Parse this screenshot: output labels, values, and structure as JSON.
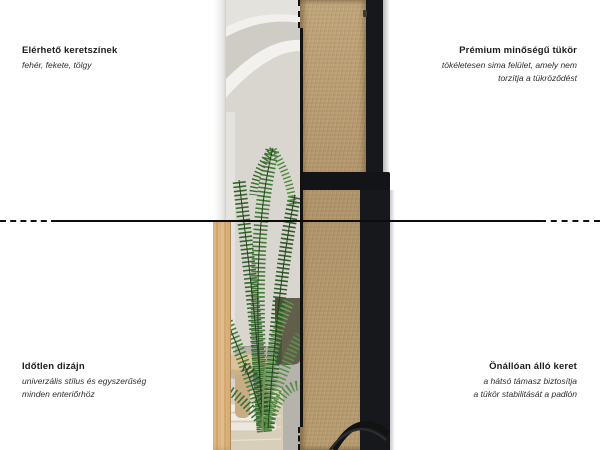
{
  "annotations": {
    "top_left": {
      "title": "Elérhető keretszínek",
      "lines": [
        "fehér, fekete, tölgy"
      ]
    },
    "top_right": {
      "title": "Prémium minőségű tükör",
      "lines": [
        "tökéletesen sima felület, amely nem",
        "torzítja a tükröződést"
      ]
    },
    "bottom_left": {
      "title": "Időtlen dizájn",
      "lines": [
        "univerzális stílus és egyszerűség",
        "minden enteriőrhöz"
      ]
    },
    "bottom_right": {
      "title": "Önállóan álló keret",
      "lines": [
        "a hátsó támasz biztosítja",
        "a tükör stabilitását a padlón"
      ]
    }
  },
  "palette": {
    "background": "#ffffff",
    "frame_black": "#17181b",
    "mdf_board": "#b2976b",
    "oak_frame": "#ddb581",
    "white_frame": "#f3f3f2",
    "guide_line": "#111111"
  }
}
